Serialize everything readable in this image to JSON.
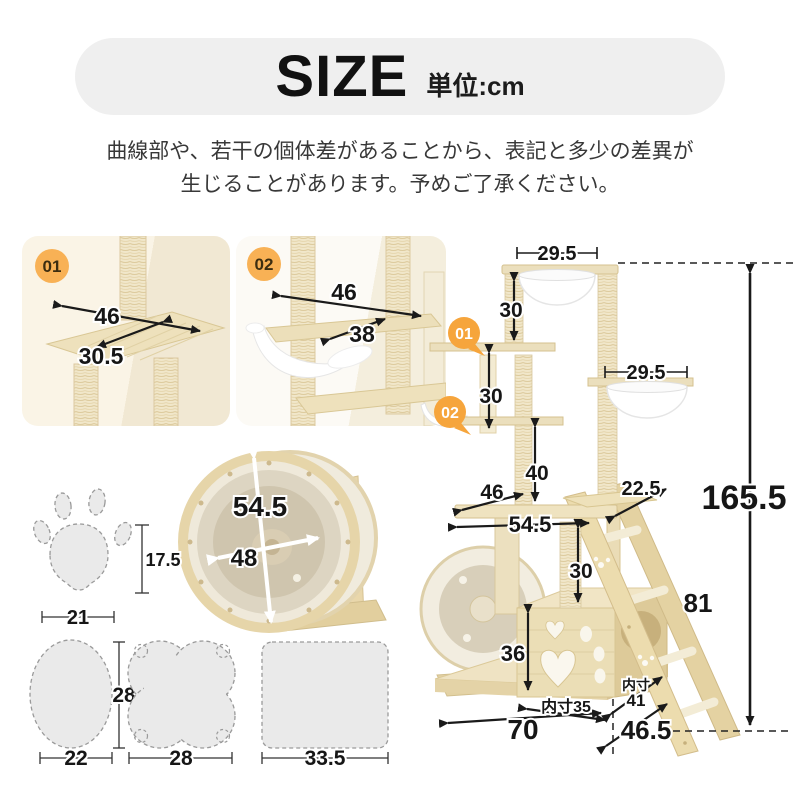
{
  "header": {
    "title": "SIZE",
    "unit_label": "単位:cm"
  },
  "notice": {
    "line1": "曲線部や、若干の個体差があることから、表記と多少の差異が",
    "line2": "生じることがあります。予めご了承ください。"
  },
  "colors": {
    "banner_bg": "#efefef",
    "badge_orange": "#f6a53c",
    "photo_badge_orange": "#f8b155",
    "wood_light": "#f0e5c6",
    "wood_mid": "#e8d8ae",
    "wood_dark": "#dcc795",
    "plate_fill": "#eaeaea",
    "dim_text": "#161616"
  },
  "detail_01": {
    "badge": "01",
    "dim_width": "46",
    "dim_depth": "30.5"
  },
  "detail_02": {
    "badge": "02",
    "dim_width": "46",
    "dim_depth": "38"
  },
  "wheel_detail": {
    "dim_outer": "54.5",
    "dim_inner": "48"
  },
  "paw_plate": {
    "dim_height": "17.5",
    "dim_width": "21"
  },
  "oval_plate": {
    "dim_height": "28",
    "dim_width": "22"
  },
  "clover_plate": {
    "dim_width": "28"
  },
  "mat_plate": {
    "dim_width": "33.5"
  },
  "tower": {
    "badge_01": "01",
    "badge_02": "02",
    "top_width": "29.5",
    "top_post": "30",
    "mid_post": "30",
    "capsule_width": "29.5",
    "third_post": "40",
    "platform_depth": "46",
    "platform_width": "54.5",
    "step_depth": "22.5",
    "total_height": "165.5",
    "lower_post": "30",
    "ladder_length": "81",
    "box_height": "36",
    "box_inner_front": "内寸35",
    "box_inner_side_line1": "内寸",
    "box_inner_side_line2": "41",
    "base_width": "70",
    "base_depth": "46.5"
  }
}
